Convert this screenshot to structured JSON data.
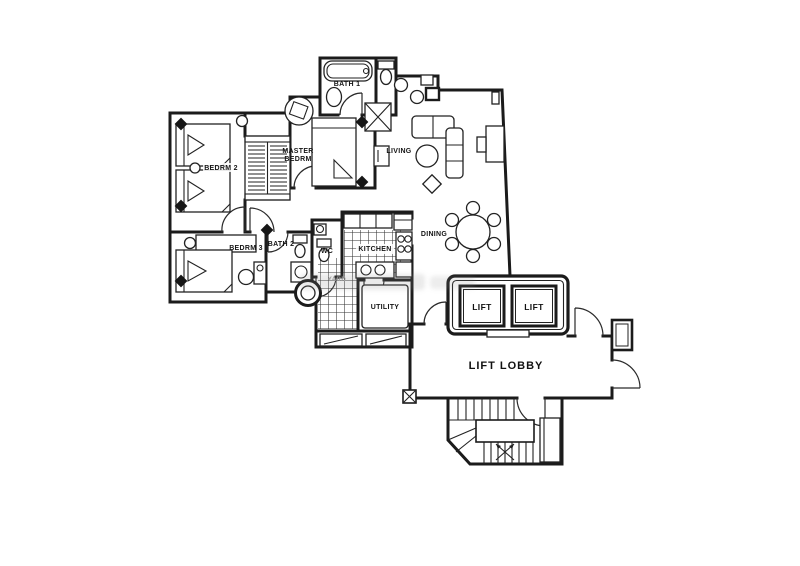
{
  "canvas": {
    "width": 800,
    "height": 566,
    "background": "#ffffff",
    "ink": "#1b1b1b"
  },
  "floor_plan": {
    "labels": {
      "bedroom2": "BEDRM 2",
      "bedroom3": "BEDRM 3",
      "master_line1": "MASTER",
      "master_line2": "BEDRM",
      "bath1": "BATH 1",
      "bath2": "BATH 2",
      "wc": "WC",
      "kitchen": "KITCHEN",
      "yard": "YARD",
      "utility": "UTILITY",
      "living": "LIVING",
      "dining": "DINING",
      "lift_left": "LIFT",
      "lift_right": "LIFT",
      "lift_lobby": "LIFT LOBBY"
    }
  }
}
